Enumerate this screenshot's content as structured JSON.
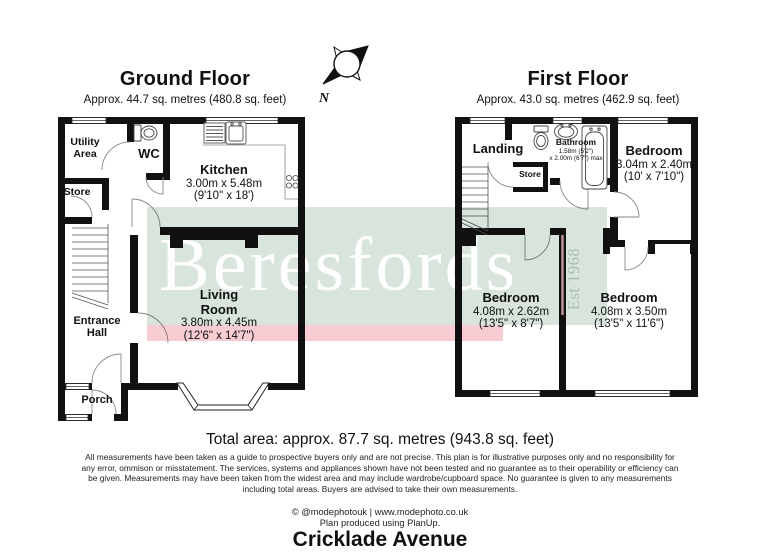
{
  "ground_floor": {
    "title": "Ground Floor",
    "subtitle": "Approx. 44.7 sq. metres (480.8 sq. feet)",
    "utility": "Utility Area",
    "wc": "WC",
    "kitchen": {
      "name": "Kitchen",
      "metric": "3.00m x 5.48m",
      "imperial": "(9'10\" x 18')"
    },
    "store": "Store",
    "entrance_hall": "Entrance Hall",
    "porch": "Porch",
    "living_room": {
      "name": "Living Room",
      "metric": "3.80m x 4.45m",
      "imperial": "(12'6\" x 14'7\")"
    }
  },
  "first_floor": {
    "title": "First Floor",
    "subtitle": "Approx. 43.0 sq. metres (462.9 sq. feet)",
    "landing": "Landing",
    "store": "Store",
    "bathroom": {
      "name": "Bathroom",
      "line1": "1.58m (5'2\")",
      "line2": "x 2.00m (6'7\") max"
    },
    "bedroom_top": {
      "name": "Bedroom",
      "metric": "3.04m x 2.40m",
      "imperial": "(10' x 7'10\")"
    },
    "bedroom_left": {
      "name": "Bedroom",
      "metric": "4.08m x 2.62m",
      "imperial": "(13'5\" x 8'7\")"
    },
    "bedroom_right": {
      "name": "Bedroom",
      "metric": "4.08m x 3.50m",
      "imperial": "(13'5\" x 11'6\")"
    }
  },
  "compass": {
    "north_label": "N"
  },
  "watermark": {
    "brand": "Beresfords",
    "established": "Est 1968",
    "band_color": "#d8e4dc",
    "accent_band_color": "#f7cdd3",
    "wall_color": "#111111"
  },
  "summary": {
    "total_area": "Total area: approx. 87.7 sq. metres (943.8 sq. feet)"
  },
  "disclaimer": "All measurements have been taken as a guide to prospective buyers only and are not precise. This plan is for illustrative purposes only and no responsibility for any error, ommison or misstatement. The services, systems and appliances shown have not been tested and no guarantee as to their operability or efficiency can be given. Measurements may have been taken from the widest area and may include wardrobe/cupboard space. No guarantee is given to any measurements including total areas. Buyers are advised to take their own measurements.",
  "credits": {
    "photo": "© @modephotouk | www.modephoto.co.uk",
    "produced": "Plan produced using PlanUp."
  },
  "address": "Cricklade Avenue"
}
